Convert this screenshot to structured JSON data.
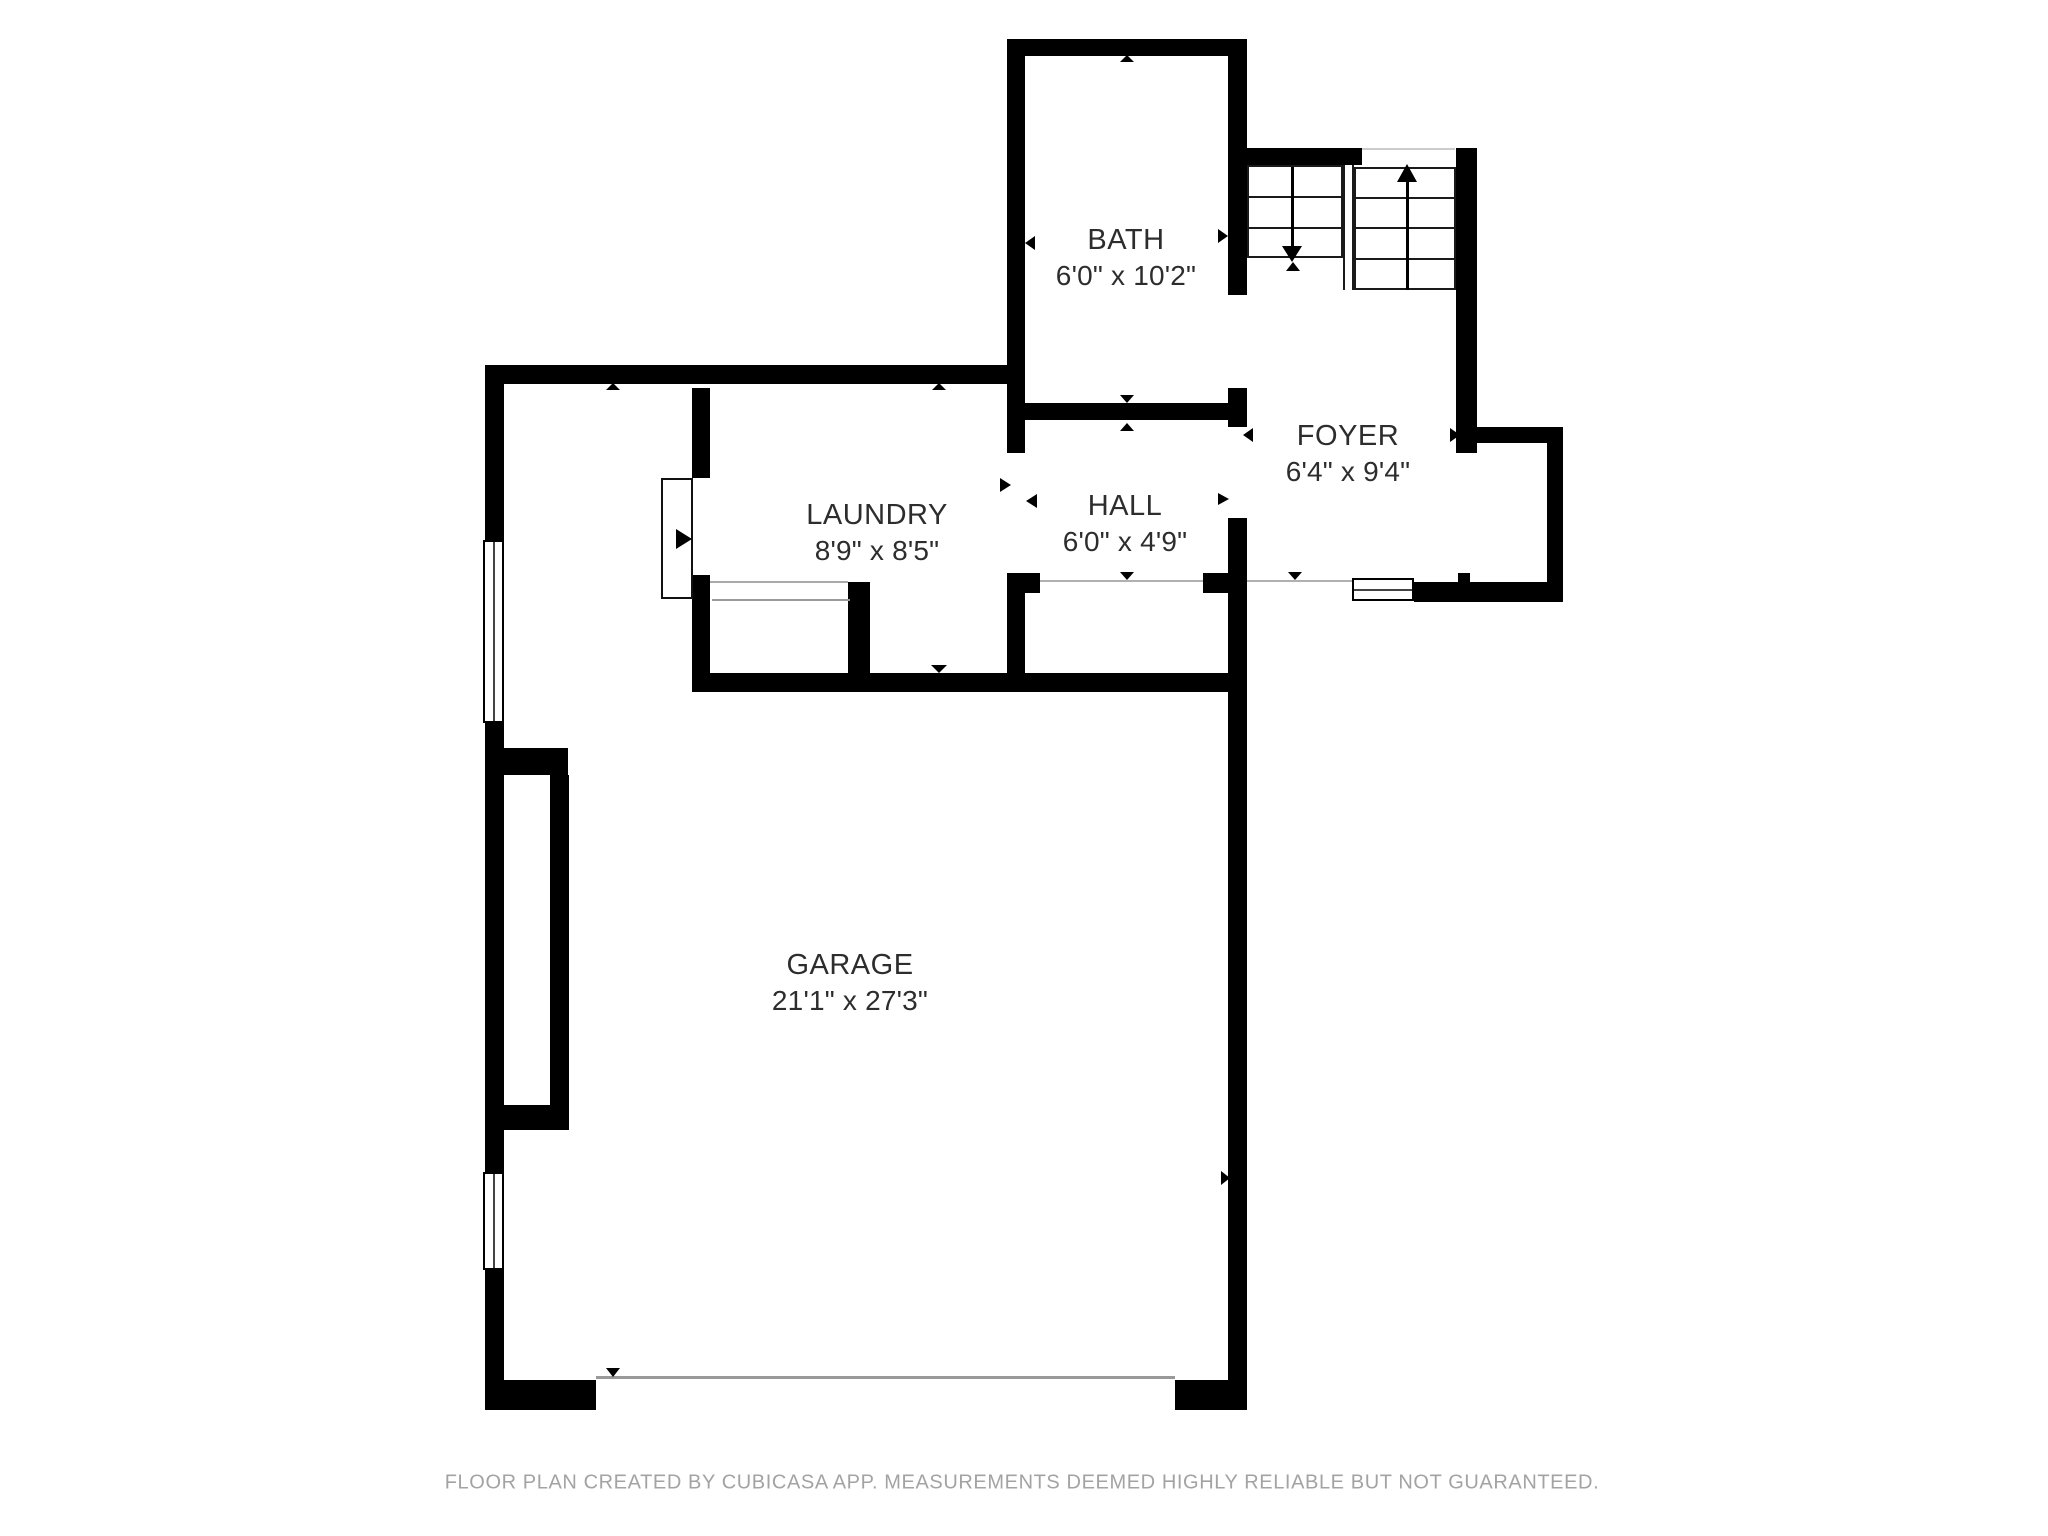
{
  "rooms": [
    {
      "id": "bath",
      "name": "BATH",
      "dims": "6'0\" x 10'2\""
    },
    {
      "id": "laundry",
      "name": "LAUNDRY",
      "dims": "8'9\" x 8'5\""
    },
    {
      "id": "hall",
      "name": "HALL",
      "dims": "6'0\" x 4'9\""
    },
    {
      "id": "foyer",
      "name": "FOYER",
      "dims": "6'4\" x 9'4\""
    },
    {
      "id": "garage",
      "name": "GARAGE",
      "dims": "21'1\" x 27'3\""
    }
  ],
  "footer": "FLOOR PLAN CREATED BY CUBICASA APP. MEASUREMENTS DEEMED HIGHLY RELIABLE BUT NOT GUARANTEED.",
  "colors": {
    "wall": "#000000",
    "label": "#2d2d2d",
    "footer": "#a3a3a3",
    "accent_line": "#aaaaaa"
  }
}
